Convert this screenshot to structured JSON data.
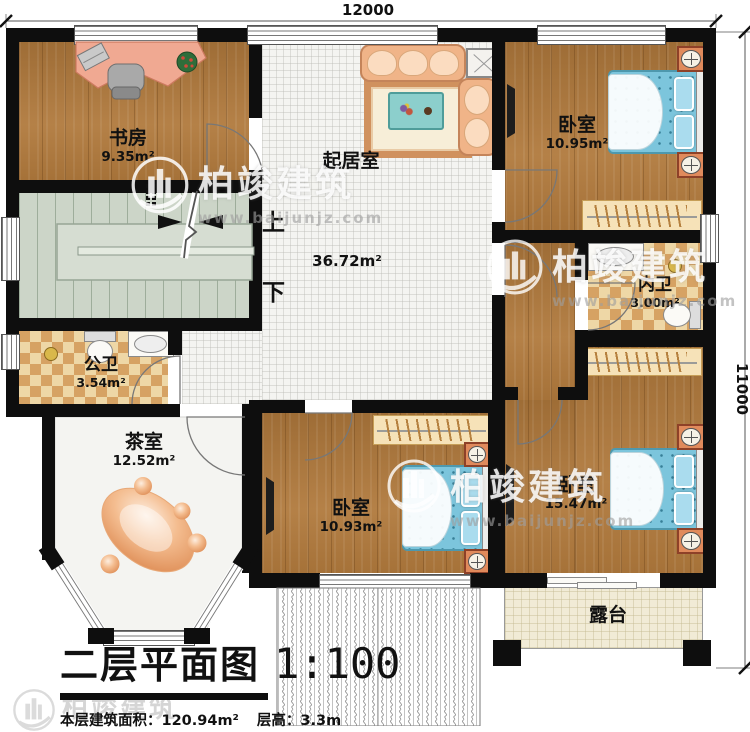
{
  "title": {
    "name": "二层平面图",
    "scale": "1:100"
  },
  "footer": {
    "area": "本层建筑面积：120.94m²",
    "height": "层高：3.3m"
  },
  "dimensions": {
    "width": "12000",
    "height": "11000"
  },
  "stairs": {
    "up": "上",
    "down": "下"
  },
  "watermark": {
    "brand": "柏竣建筑",
    "url": "www.baijunjz.com"
  },
  "rooms": [
    {
      "id": "study",
      "name": "书房",
      "area": "9.35m²"
    },
    {
      "id": "living",
      "name": "起居室",
      "area": "36.72m²"
    },
    {
      "id": "bedroom-top",
      "name": "卧室",
      "area": "10.95m²"
    },
    {
      "id": "inner-bath",
      "name": "内卫",
      "area": "3.00m²"
    },
    {
      "id": "public-bath",
      "name": "公卫",
      "area": "3.54m²"
    },
    {
      "id": "tea-room",
      "name": "茶室",
      "area": "12.52m²"
    },
    {
      "id": "bedroom-mid",
      "name": "卧室",
      "area": "10.93m²"
    },
    {
      "id": "bedroom-right",
      "name": "卧室",
      "area": "15.47m²"
    },
    {
      "id": "terrace",
      "name": "露台",
      "area": ""
    }
  ],
  "colors": {
    "wall": "#0e0e0e",
    "wood": "#b0793c",
    "bed": "#7cc5dc",
    "checker_light": "#eed7a6",
    "checker_dark": "#d6a263",
    "stair": "#ccd5c8",
    "terrace": "#f1ebd6"
  }
}
